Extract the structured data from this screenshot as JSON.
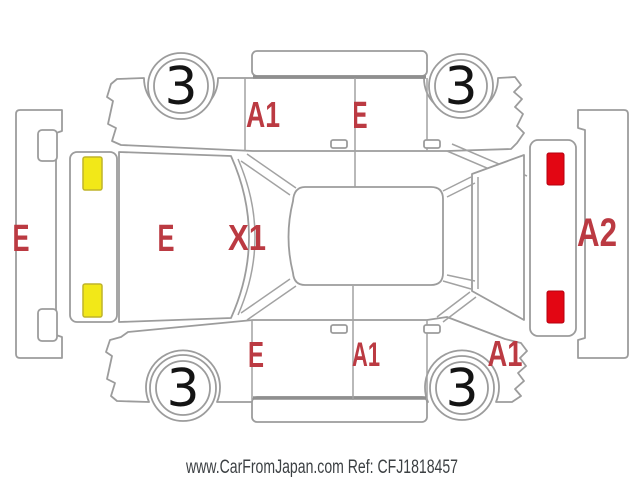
{
  "page": {
    "watermark": "www.CarFromJapan.com Ref: CFJ1818457"
  },
  "diagram": {
    "type": "vehicle-inspection-unfolded-diagram",
    "damage_codes": {
      "front_bumper": "E",
      "hood": "E",
      "windshield": "X1",
      "upper_side_front_door": "A1",
      "upper_side_rear_door": "E",
      "lower_side_front_fender": "E",
      "lower_side_doors": "A1",
      "lower_side_rear_quarter": "A1",
      "rear_bumper": "A2"
    },
    "wheels": {
      "top_left": "3",
      "top_right": "3",
      "bottom_left": "3",
      "bottom_right": "3"
    },
    "colors": {
      "damage_text": "#bb3a42",
      "marker_yellow": "#f2e818",
      "marker_yellow_border": "#bfb42a",
      "marker_red": "#e30613",
      "marker_red_border": "#b5000f",
      "outline_gray": "#9c9c9c",
      "watermark_text": "#3c4043"
    }
  }
}
